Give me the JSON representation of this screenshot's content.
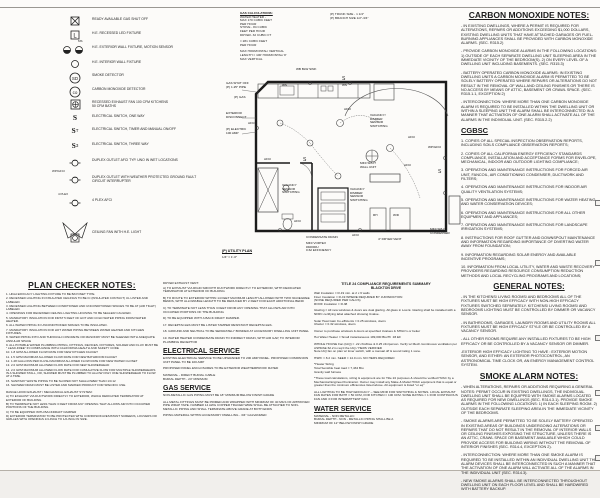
{
  "legend": {
    "sym": {
      "l": "L",
      "ms": "MS",
      "sd": "SD",
      "co": "co",
      "s": "S",
      "t": "T",
      "three": "3",
      "wp_tag": "WP/GFCI",
      "plex_tag": "4 PLEX"
    },
    "items": [
      {
        "label": "READY AVAILABLE GAS SHUT OFF"
      },
      {
        "label": "H.E. RECESSED LED FIXTURE"
      },
      {
        "label": "H.E. EXTERIOR WALL FIXTURE, MOTION SENSOR"
      },
      {
        "label": "H.E. INTERIOR WALL FIXTURE"
      },
      {
        "label": "SMOKE DETECTOR"
      },
      {
        "label": "CARBON MONOXIDE DETECTOR"
      },
      {
        "label": "RECESSED EXHAUST FAN 100 CFM KITCHENS\n50 CFM BATHS"
      },
      {
        "label": "ELECTRICAL SWITCH, ONE WAY"
      },
      {
        "label": "ELECTRICAL SWITCH, TIMER AND MANUAL ON/OFF"
      },
      {
        "label": "ELECTRICAL SWITCH, THREE WAY"
      },
      {
        "label": "DUPLEX OUTLET AFCI TYP. UNO IN WET LOCATIONS"
      },
      {
        "label": "DUPLEX OUTLET WITH WEATHER PROTECTED GROUND FAULT\nCIRCUIT INTERRUPTER"
      },
      {
        "label": "4 PLEX AFCI"
      },
      {
        "label": "CEILING FAN WITH H.E. LIGHT"
      }
    ]
  },
  "gas_calculations": {
    "title": "GAS CALCULATIONS:",
    "body": "WATER HEATER -\nMAX 170 CUBIC FEET\nPER HOUR\nSTOVE - 84 CUBIC\nFEET PER HOUR\nDRYER- 32 CUBIC FT",
    "total": "= 281 CUBIC FEET\nPER HOUR",
    "max_len": "MAX HORIZONTAL/ VERTICAL\nLENGTH = 100' HORIZONTAL/ 8'\nMAX VERTICAL"
  },
  "pipe_sizes": {
    "trunk": "(P) TRUNK SIZE - 1 1/4\"",
    "branch": "(P) BRANCH SIZE 1/2\"-3/4\""
  },
  "plan": {
    "sink_note": "WB BLW SINK",
    "gas_shut_off": "GAS SHUT OFF\n(P) 1.25\" PIPE",
    "p_gas": "(P) GAS",
    "exterior_disconnect": "EXTERIOR\nDISCONNECT",
    "p_electric": "(P) ELECTRIC\n100 AMP",
    "vacancy_dimmer_1": "VACANCY/\nDIMMER\nSENSOR\nSWITCHING",
    "vacancy_sensor": "VACANCY\nSENSOR\nSWITCHING",
    "vacancy_dimmer_2": "VACANCY\nDIMMER\nSENSOR\nSWITCHING",
    "mini_split_wall": "MINI SPLIT\nWALL UNIT",
    "mini_split_condenser": "MINI SPLIT\nCONDENSER",
    "condensate_drain": "CONDENSATE DRAIN",
    "vortex": "MINI VORTEX\n#40000U\n0.62 EFFICIENCY",
    "dryer_vent": "4\" DRYER VENT",
    "wp_gfci": "WP/GFCI",
    "afci": "AFCI",
    "ws": "WS",
    "wd": "W/D",
    "rh": "RH",
    "switch_letter": "S",
    "caption_title": "(P) UTILITY PLAN",
    "caption_scale": "1/4\" = 1'-0\""
  },
  "plan_checker": {
    "title": "PLAN CHECKER NOTES:",
    "items": [
      "1. HIGH EFFICACY LIGHTING FIXTURE TO BE BAYONET TYPE.",
      "2. RECESSED LIGHTING IN INSULATED CEILINGS TO BE IC (INSULATED CONTACT) UL LISTED AND LABELED.",
      "3. RECESSED LIGHTING BETWEEN CONDITIONED AND UNCONDITIONED SPACES TO BE AT (AIR TIGHT) LABELED.",
      "4. OPENINGS FOR RECESSED CEILING LIGHTING HOUSING TO BE SEALED/ CAULKED.",
      "5. MANDATORY INSULATION FOR FIRST 5 FEET OF HOT AND COLD WATER PIPING FROM WATER HEATER.",
      "6. ALL WATER PIPING IN UNCONDITIONED SPACES TO BE INSULATED.",
      "7. MANDATORY INSULATION FOR HOT WATER PIPING BETWEEN WATER HEATER AND KITCHEN FIXTURES.",
      "8. WATER PIPING INTO AND THROUGH CONCRETE OR MASONRY MUST BE SLEEVED WITH ADEQUATE ANNULAR SPACE",
      "9. ALL POTABLE WATER PLUMBING PIPING, FITTINGS, DEVICES, FIXTURES, SOLDER AND FLUX MUST BE \" LEAD-FREE\" IN COMPLIANCE WITH CALIFORNIA HEALTH AND SAFETY CODE",
      "10. 1.8 GPM ALLOWED FLOW RATE FOR NEW KITCHEN FAUCET",
      "11. 1.5 GPM MAXIMUM ALLOWED FLOW RATE FOR NEW BATHROOM FAUCET",
      "12. 1.28 GALLONS PER FLUSH MAXIMUM ALLOWED FLOW RATE FOR NEW WATER CLOSET",
      "13. 2.0 GPM MAXIMUM ALLOWED FLOW RATE FOR NEW SHOWERHEAD",
      "14. 2.0 GPM MAXIMUM ALLOWED FLOW RATE FOR CUMULATIVE FLOW FOR MULTIPLE SHOWERHEADS IN A SHOWER STALL, OR, SHOWER MUST BE PLUMBED TO ALLOW ONLY ONE SHOWERHEAD TO FLOW AT A TIME.",
      "15. SANITARY WASTE PIPING TO BE SLOPED NOT SHALLOWER THAN 1/4:12",
      "16. SHOWER DRAIN MUST BE LISTED AND MARKED PRODUCT FOR SPECIFIC USE."
    ],
    "range_hood_title": "RANGE HOOD EXHAUST / MECHANICAL EXHAUST SYSTEM:",
    "range_hood": [
      "A) TO EXHAUST VIA DUCTWORK DIRECTLY TO EXTERIOR, WHICH DEDICATED TERMINATOR AT EXTERIOR OF BUILDING",
      "B) TO TERMINATE NOT LESS THAN 3 FEET FROM ANY OPENING THAT ALLOWS AIR INTO OCCUPIED PORTIONS OF THE BUILDING",
      "C) TO BE EQUIPPED WITH BACKDRAFT DAMPER",
      "D) EXTERIOR TERMINATOR TO BE PROTECTED WITH CORROSION-RESISTANT SCREENS, LOUVERS OR GRILLES WITH OPENINGS 1/4-INCH TO 1/2-INCH IN SIZE."
    ]
  },
  "column2": {
    "dryer_title": "DRYER EXHAUST VENT:",
    "dryer_lines": [
      "A) TO EXHAUST VIA RIGID SMOOTH DUCTWORK DIRECTLY TO EXTERIOR, WITH DEDICATED TERMINATOR AT EXTERIOR OF BUILDING",
      "B) TO ROUTE TO EXTERIOR WITHIN 14 FEET MAXIMUM LENGTH ALLOWED WITH TWO 90-DEGREE BENDS, WITH ALLOWABLE LENGTH TO BE REDUCED BY 2 FEET FOR EACH ADDITIONAL BEND",
      "C) TO TERMINATE NOT LESS THAN 3 FEET FROM ANY OPENING THAT ALLOWS AIR INTO OCCUPIED PORTIONS OF THE BUILDING",
      "D) TO BE EQUIPPED WITH A BACK DRAFT DAMPER."
    ],
    "numbered": [
      "17. RECEPTACLES MUST BE LISTED TAMPER RESISTANT RECEPTACLES.",
      "18. GROUND AND NEUTRAL TO BE SEPARATELY BONDED AT ACCESSORY DWELLING UNIT PANEL",
      "19. WATER HEATER CONDENSATE DRAIN TO INDIRECT DRAIN, WITH AIR GAP, TO INTERIOR PLUMBING RECEPTOR"
    ],
    "electrical_title": "ELECTRICAL SERVICE",
    "electrical": [
      "EXISTING ELECTRICAL SERVICE TO BE UPGRADED TO 200 AMP PANEL. PROPOSED COMPANION UNIT PANEL TO BE 100 AMP",
      "PROPOSED PANEL ENCLOSURES TO BE EXTERIOR WEATHERPROOF RATED",
      "MATERIAL - DIRECT BURIAL CABLE\nBURIAL DEPTH - 24\" MINIMUM"
    ],
    "gas_title": "GAS SERVICE",
    "gas": [
      "NON-METALLIC GAS PIPING MUST BE 18\" MINIMUM BELOW FINISH GRADE",
      "ALL METAL FITTINGS MUST BE PRIMED AND WRAPPED WITH MINIMUM OF 40 MILS OF APPROVED PIPE WRAP TAPE. NUMBER 14 AWG COPPER TRACER WIRE SHALL BE ATTACHED TO NON-METALLIC PIPING AND SHALL TERMINATE ABOVE GRADE AT BOTH ENDS",
      "PIPING MATERIAL WITHIN ACCESSORY DWELLING - 3/4\" GALVANIZED"
    ]
  },
  "title24": {
    "title": "TITLE 24 COMPLIANCE REQUIREMENTS SUMMARY",
    "subtitle": "BLACKTON DRIVE",
    "paragraphs": [
      "Wall Insulation = R-19 min. at 2 x 6 walls\nFloor Insulation = R-19 WHERE REQUIRED BY JURISDICTION\n(NONE REQUIRED PER CALCS)\nROOF Insulation = R-38",
      "Glazing = All new windows & doors are dual glazing. All glass in Low E. Glazing shall be installed with a NFRC certifying label attached showing Uvalue.",
      "Solar Heat Gain Co-efficients = 0.25 windows, doors\nUfactor = 0.32 windows, doors",
      "Owner to purchase windows & doors at specified Uvalues & SHGC's or better",
      "Hot Water Heater = Small instantaneous 199,000 Btu/Hr .93 EF",
      "WHOLE HOUSE Fan (IAQ) = .22 cfm/Dwe & 0.25 cfm/person. Verify w/ Mech./continuous ventilation per ASHRAE 62.2 is req'd the IAQ / HERS VERIFIED\nNote IAQ fan on plan w/ timer switch, with a manual off & sound rating 1 sone.",
      "HSPF = 8.2 min. SEER = 14.0 min. NO HERS REQUIRED",
      "*Heater Sizing\nTotal        Sensible heat load = 7,434 Btu\n                Gravity wall furnace",
      "*These load calculations, sizing & equipment are for Title 24 purposes & should be verified HVAC by a Mechanical Engineer/Contractor. Owner may install any Make & Model HVAC equipment that is equal or greater than the minimum efficiencies listed above. All equipment is listed \"or eq\"",
      "ALL LIGHTING TO BE HIGH EFFICACY -- SEE MFIR FOR SWITCHING & NOTES. LOCAL EXHAUST FAN RATES FOR BATH = 50 CFM, FOR KITCHEN = 100 CFM. SONE RATING = 1 FOR CONTINUOUS FAN AND 3 FOR INTERMITTENT FAN."
    ]
  },
  "water_service": {
    "title": "WATER SERVICE",
    "paragraphs": [
      "MATERIAL - NON METALLIC\nBURIAL DEPTH - NON - METALLIC PIPING SHALL BE A\nMINIMUM OF 12\" BELOW FINISH GRADE"
    ]
  },
  "co_notes": {
    "title": "CARBON MONOXIDE NOTES:",
    "paragraphs": [
      "- IN EXISTING DWELLINGS, WHERE A PERMIT IS REQUIRED FOR ALTERATIONS, REPAIRS OR ADDITIONS EXCEEDING $1,000 DOLLARS, EXISTING DWELLING UNITS THAT HAVE ATTACHED GARAGES OR FUEL-BURNING APPLIANCES SHALL BE PROVIDED WITH CARBON MONOXIDE ALARMS. (SEC. R315.2)",
      "- PROVIDE CARBON MONOXIDE ALARMS IN THE FOLLOWING LOCATIONS: 1) OUTSIDE OF EACH SEPARATE DWELLING UNIT SLEEPING AREA IN THE IMMEDIATE VICINITY OF THE BEDROOM(S). 2) ON EVERY LEVEL OF A DWELLING UNIT INCLUDING BASEMENTS. (SEC. R315.3)",
      "- BATTERY OPERATED CARBON MONOXIDE ALARMS: IN EXISTING DWELLING UNITS A CARBON MONOXIDE ALARM IS PERMITTED TO BE SOLELY BATTERY OPERATED WHERE REPAIRS OR ALTERATIONS DO NOT RESULT IN THE REMOVAL OF WALL AND CEILING FINISHES OR THERE IS NO ACCESS BY MEANS OF ATTIC, BASEMENT OR CRAWL SPACE. (SEC. R315.1.1, EXCEPTION 2)",
      "- INTERCONNECTION: WHERE MORE THAN ONE CARBON MONOXIDE ALARM IS REQUIRED TO BE INSTALLED WITHIN THE DWELLING UNIT OR WITHIN A SLEEPING UNIT THE ALARM SHALL BE INTERCONNECTED IN A MANNER THAT ACTIVATION OF ONE ALARM SHALL ACTIVATE ALL OF THE ALARMS IN THE INDIVIDUAL UNIT. (SEC. R315.2.2)"
    ]
  },
  "cgbsc": {
    "title": "CGBSC",
    "items": [
      "1. COPIES OF ALL SPECIAL INSPECTION OBSERVATION REPORTS, INCLUDING SOILS COMPLIANCE OBSERVATION REPORTS;",
      "2. COPIES OF ALL CALIFORNIA ENERGY EFFICIENCY STANDARDS COMPLIANCE, INSTALLATION AND ACCEPTANCE FORMS FOR ENVELOPE, MECHANICAL, INDOOR AND OUTDOOR LIGHTING COMPLIANCE;",
      "3. OPERATION AND MAINTENANCE INSTRUCTIONS FOR FORCED AIR UNIT, FANCOIL, AIR CONDITIONING CONDENSER, DUCTWORK AND FILTERS;",
      "4. OPERATION AND MAINTENANCE INSTRUCTIONS FOR INDOOR AIR QUALITY VENTILATION SYSTEMS;",
      "5. OPERATION AND MAINTENANCE INSTRUCTIONS FOR WATER HEATING AND WATER CONSERVATION DEVICES;",
      "6. OPERATION AND MAINTENANCE INSTRUCTIONS FOR ALL OTHER EQUIPMENT AND APPLIANCES;",
      "7. OPERATION AND MAINTENANCE INSTRUCTIONS FOR LANDSCAPE IRRIGATION SYSTEMS;",
      "8. INSTRUCTIONS FOR ROOF GUTTER AND DOWNSPOUT MAINTENANCE AND INFORMATION REGARDING IMPORTANCE OF DIVERTING WATER AWAY FROM FOUNDATION;",
      "9. INFORMATION REGARDING SOLAR ENERGY AND AVAILABLE INCENTIVE PROGRAMS;",
      "10. INFORMATION FROM LOCAL UTILITY, WATER AND WASTE RECOVERY PROVIDERS REGARDING RESOURCE CONSUMPTION REDUCTION METHODS AND LOCAL RECYCLING PROGRAMS AND LOCATIONS;"
    ]
  },
  "general_notes": {
    "title": "GENERAL NOTES:",
    "paragraphs": [
      "- IN THE KITCHENS/ LIVING ROOMS/ AND BEDROOMS ALL OF THE FIXTURES MUST BE HIGH EFFICACY WITH NON-HIGH EFFICACY FIXTURES SWITCHED SEPARATELY. KITCHENS/ LIVING ROOMS/ AND BEDROOMS LIGHTING MUST BE CONTROLLED BY DIMMER OR VACANCY SENSOR.",
      "- IN BATHROOMS, GARAGES, LAUNDRY ROOMS AND UTILITY ROOMS ALL FIXTURES MUST BE HIGH EFFICACY STYLE OR BE CONTROLLED BY A VACANCY SENSOR.",
      "- ALL OTHER ROOMS REQUIRE ANY INSTALLED FIXTURES TO BE HIGH EFFICACY OR BE CONTROLLED BY A VACANCY SENSOR OR DIMMER.",
      "-EXTERIOR HIGH EFFICACY LIGHTING TO HAVE : EXTERIOR MOTION SENSOR, AND EITHER: AN EXTERIOR PHOTOCONTROL, AN ASTRONOMICAL TIME CLOCK OR, AN ENERGY MANAGEMENT CONTROL SYSTEM."
    ]
  },
  "smoke_notes": {
    "title": "SMOKE ALARM NOTES:",
    "paragraphs": [
      "- WHEN ALTERATIONS, REPAIRS OR ADDITIONS REQUIRING A GENERAL NOTES: PERMIT OCCUR IN EXISTING DWELLINGS, THE INDIVIDUAL DWELLING UNIT SHALL BE EQUIPPED WITH SMOKE ALARMS LOCATED AS REQUIRED FOR NEW DWELLINGS (SEC. R314.3.1). PROVIDE SMOKE ALARMS IN THE FOLLOWING LOCATIONS: 1) IN EACH SLEEPING ROOM. 2) OUTSIDE EACH SEPARATE SLEEPING AREA IN THE IMMEDIATE VICINITY OF THE BEDROOMS.",
      "- SMOKE ALARMS ARE PERMITTED TO BE SOLELY BATTERY OPERATED IN EXISTING AREAS OF BUILDINGS UNDERGOING ALTERATIONS OR REPAIRS THAT DO NOT RESULT IN THE REMOVAL OF INTERIOR WALLS OR CEILING FINISHES EXPOSING THE STRUCTURE, UNLESS THERE IS AN ATTIC, CRAWL SPACE OR BASEMENT AVAILABLE WHICH COULD PROVIDE ACCESS FOR BUILDING WIRING WITHOUT THE REMOVAL OF INTERIOR FINISHES (SEC. R314.4, EXCEPTION 2).",
      "- INTERCONNECTION: WHERE MORE THAN ONE SMOKE ALARM IS REQUIRED TO BE INSTALLED WITHIN AN INDIVIDUAL DWELLING UNIT THE ALARM DEVICES SHALL BE INTERCONNECTED IN SUCH A MANNER THAT THE ACTIVATION OF ONE ALARM WILL ACTIVATE ALL OF THE ALARMS IN THE INDIVIDUAL UNIT (SEC. R314.3).",
      "- NEW SMOKE ALARMS SHALL BE INTERCONNECTED THROUGHOUT DWELLING UNIT ON EACH FLOOR LEVEL AND SHALL BE HARDWIRED WITH BATTERY BACKUP."
    ]
  }
}
